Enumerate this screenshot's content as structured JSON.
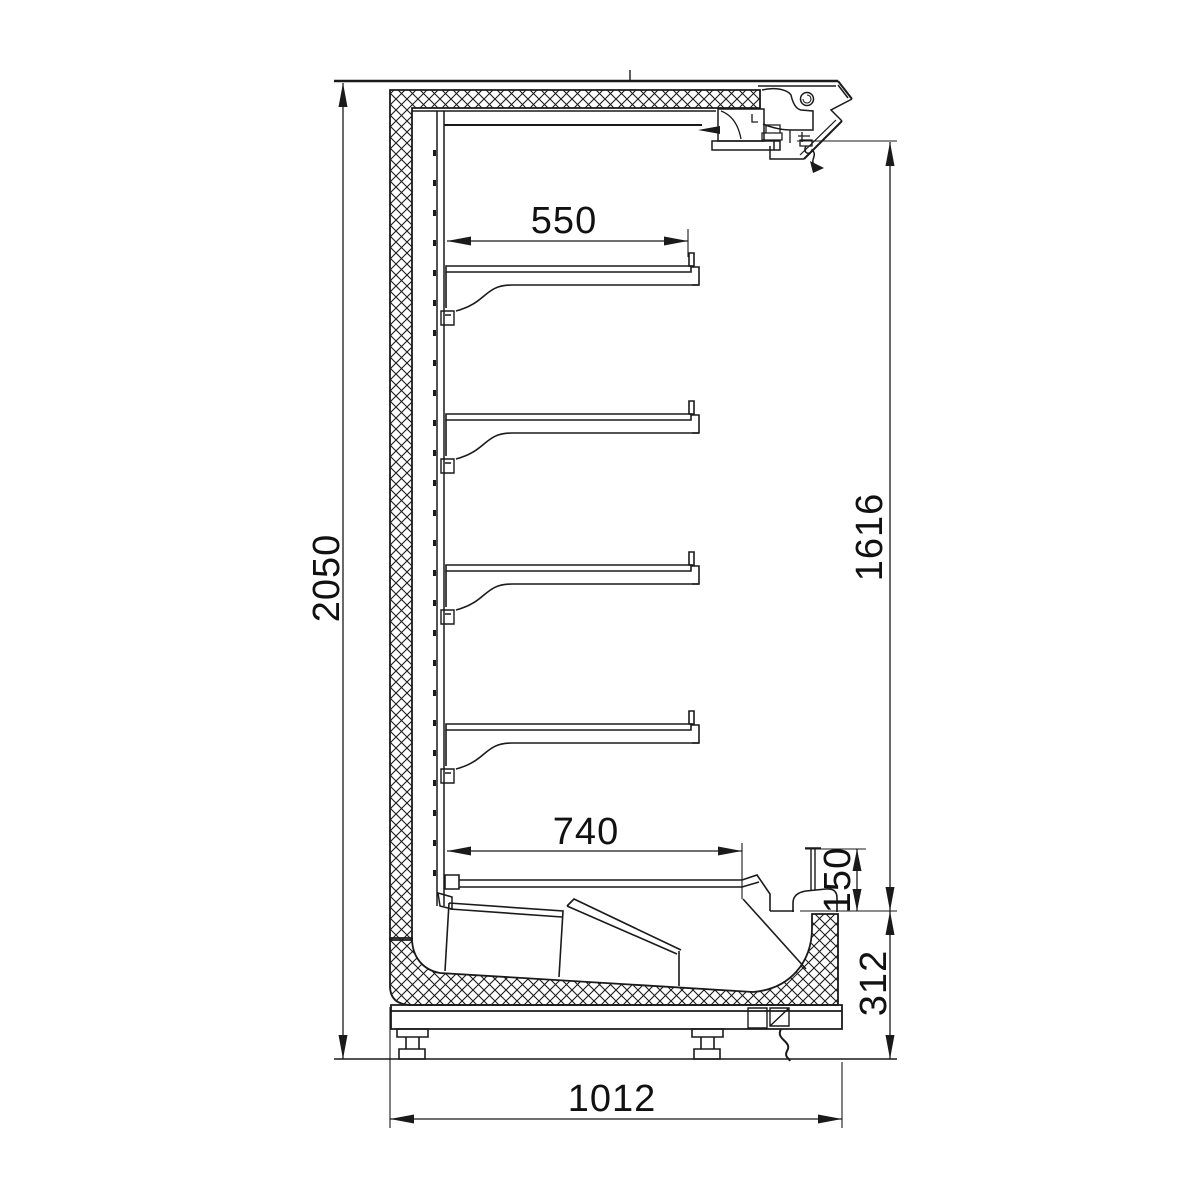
{
  "drawing": {
    "dimension_labels": {
      "overall_height": "2050",
      "shelf_depth": "550",
      "front_height": "1616",
      "base_well_depth": "740",
      "front_riser_height": "150",
      "base_height": "312",
      "overall_depth": "1012"
    },
    "colors": {
      "line": "#1a1a1a",
      "background": "#ffffff"
    }
  }
}
